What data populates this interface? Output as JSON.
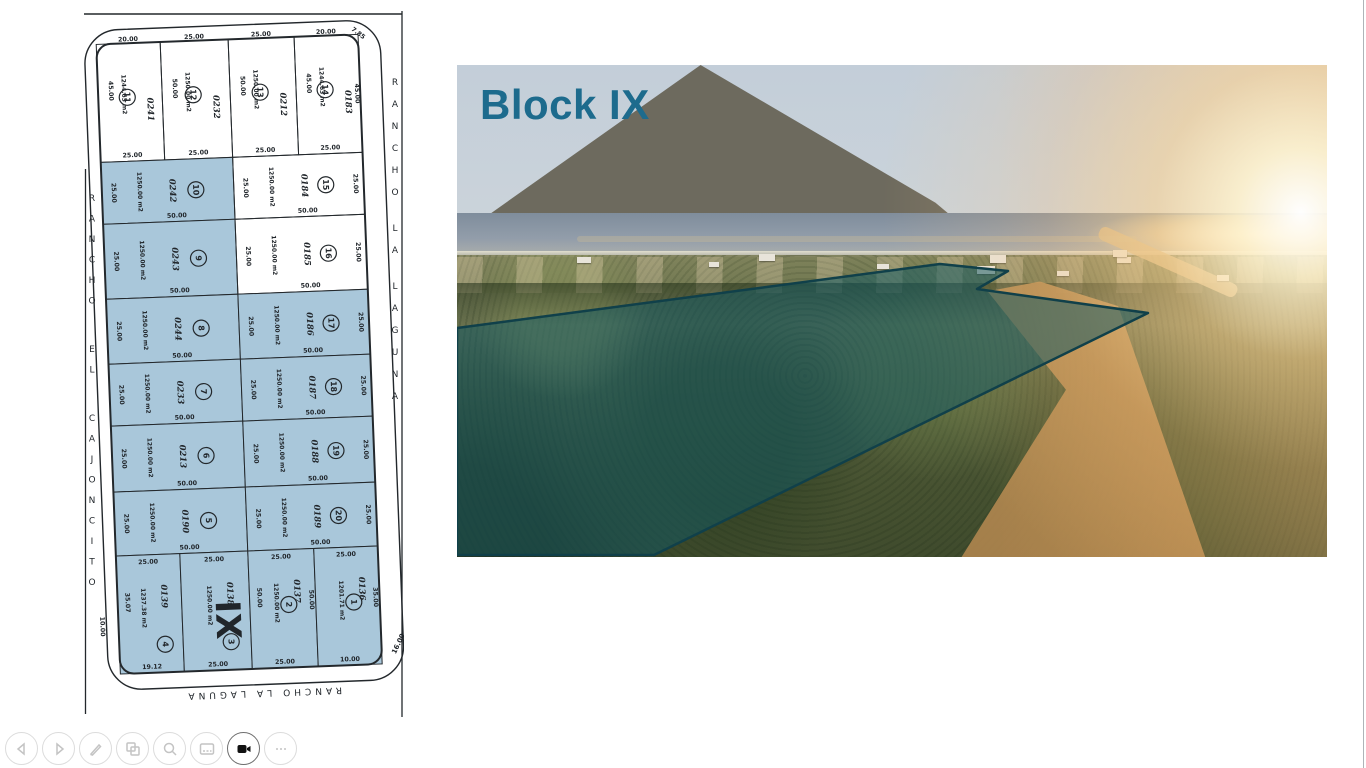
{
  "slide": {
    "title": "Block IX",
    "title_color": "#1d6b8d"
  },
  "map": {
    "street_left": "RANCHO EL CAJONCITO",
    "street_right": "RANCHO LA LAGUNA",
    "street_bottom": "RANCHO LA LAGUNA",
    "block_label": "IX",
    "highlight_color": "#a9c7da",
    "corner_dims": {
      "top_right": "7.85",
      "bottom_right": "16.00",
      "bottom_left": "10.00"
    },
    "lots": [
      {
        "n": "11",
        "code": "0241",
        "area": "1244.63 m2",
        "hl": false,
        "row": "top",
        "col": 0,
        "top": "20.00",
        "bottom": "25.00",
        "side": "45.00"
      },
      {
        "n": "12",
        "code": "0232",
        "area": "1250.00 m2",
        "hl": false,
        "row": "top",
        "col": 1,
        "top": "25.00",
        "bottom": "25.00",
        "side": "50.00"
      },
      {
        "n": "13",
        "code": "0212",
        "area": "1250.00 m2",
        "hl": false,
        "row": "top",
        "col": 2,
        "top": "25.00",
        "bottom": "25.00",
        "side": "50.00"
      },
      {
        "n": "14",
        "code": "0183",
        "area": "1244.63 m2",
        "hl": false,
        "row": "top",
        "col": 3,
        "top": "20.00",
        "bottom": "25.00",
        "side": "45.00",
        "right": "45.00"
      },
      {
        "n": "10",
        "code": "0242",
        "area": "1250.00 m2",
        "hl": true,
        "row": 1,
        "col": "L",
        "left": "25.00",
        "bottom": "50.00"
      },
      {
        "n": "15",
        "code": "0184",
        "area": "1250.00 m2",
        "hl": false,
        "row": 1,
        "col": "R",
        "left": "25.00",
        "bottom": "50.00",
        "right": "25.00"
      },
      {
        "n": "9",
        "code": "0243",
        "area": "1250.00 m2",
        "hl": true,
        "row": 2,
        "col": "L",
        "left": "25.00",
        "bottom": "50.00"
      },
      {
        "n": "16",
        "code": "0185",
        "area": "1250.00 m2",
        "hl": false,
        "row": 2,
        "col": "R",
        "left": "25.00",
        "bottom": "50.00",
        "right": "25.00"
      },
      {
        "n": "8",
        "code": "0244",
        "area": "1250.00 m2",
        "hl": true,
        "row": 3,
        "col": "L",
        "left": "25.00",
        "bottom": "50.00"
      },
      {
        "n": "17",
        "code": "0186",
        "area": "1250.00 m2",
        "hl": true,
        "row": 3,
        "col": "R",
        "left": "25.00",
        "bottom": "50.00",
        "right": "25.00"
      },
      {
        "n": "7",
        "code": "0233",
        "area": "1250.00 m2",
        "hl": true,
        "row": 4,
        "col": "L",
        "left": "25.00",
        "bottom": "50.00"
      },
      {
        "n": "18",
        "code": "0187",
        "area": "1250.00 m2",
        "hl": true,
        "row": 4,
        "col": "R",
        "left": "25.00",
        "bottom": "50.00",
        "right": "25.00"
      },
      {
        "n": "6",
        "code": "0213",
        "area": "1250.00 m2",
        "hl": true,
        "row": 5,
        "col": "L",
        "left": "25.00",
        "bottom": "50.00"
      },
      {
        "n": "19",
        "code": "0188",
        "area": "1250.00 m2",
        "hl": true,
        "row": 5,
        "col": "R",
        "left": "25.00",
        "bottom": "50.00",
        "right": "25.00"
      },
      {
        "n": "5",
        "code": "0190",
        "area": "1250.00 m2",
        "hl": true,
        "row": 6,
        "col": "L",
        "left": "25.00",
        "bottom": "50.00"
      },
      {
        "n": "20",
        "code": "0189",
        "area": "1250.00 m2",
        "hl": true,
        "row": 6,
        "col": "R",
        "left": "25.00",
        "bottom": "50.00",
        "right": "25.00"
      },
      {
        "n": "4",
        "code": "0139",
        "area": "1237.38 m2",
        "hl": true,
        "row": "bottom",
        "col": 0,
        "top": "25.00",
        "bottom": "19.12",
        "side": "35.07"
      },
      {
        "n": "3",
        "code": "0138",
        "area": "1250.00 m2",
        "hl": true,
        "row": "bottom",
        "col": 1,
        "top": "25.00",
        "bottom": "25.00"
      },
      {
        "n": "2",
        "code": "0137",
        "area": "1250.00 m2",
        "hl": true,
        "row": "bottom",
        "col": 2,
        "top": "25.00",
        "bottom": "25.00",
        "side": "50.00",
        "right": "50.00"
      },
      {
        "n": "1",
        "code": "0136",
        "area": "1201.71 m2",
        "hl": true,
        "row": "bottom",
        "col": 3,
        "top": "25.00",
        "bottom": "10.00",
        "right": "35.00"
      }
    ]
  },
  "photo": {
    "overlay_fill": "rgba(17,88,99,0.52)",
    "overlay_stroke": "#10404a"
  },
  "toolbar": {
    "buttons": [
      {
        "id": "previous-slide",
        "icon": "arrow-left-icon",
        "active": false
      },
      {
        "id": "next-slide",
        "icon": "arrow-right-icon",
        "active": false
      },
      {
        "id": "pen",
        "icon": "pen-icon",
        "active": false
      },
      {
        "id": "see-all-slides",
        "icon": "slides-grid-icon",
        "active": false
      },
      {
        "id": "zoom-slide",
        "icon": "magnifier-icon",
        "active": false
      },
      {
        "id": "captions",
        "icon": "captions-icon",
        "active": false
      },
      {
        "id": "camera",
        "icon": "camera-icon",
        "active": true
      },
      {
        "id": "more-options",
        "icon": "ellipsis-icon",
        "active": false
      }
    ]
  }
}
